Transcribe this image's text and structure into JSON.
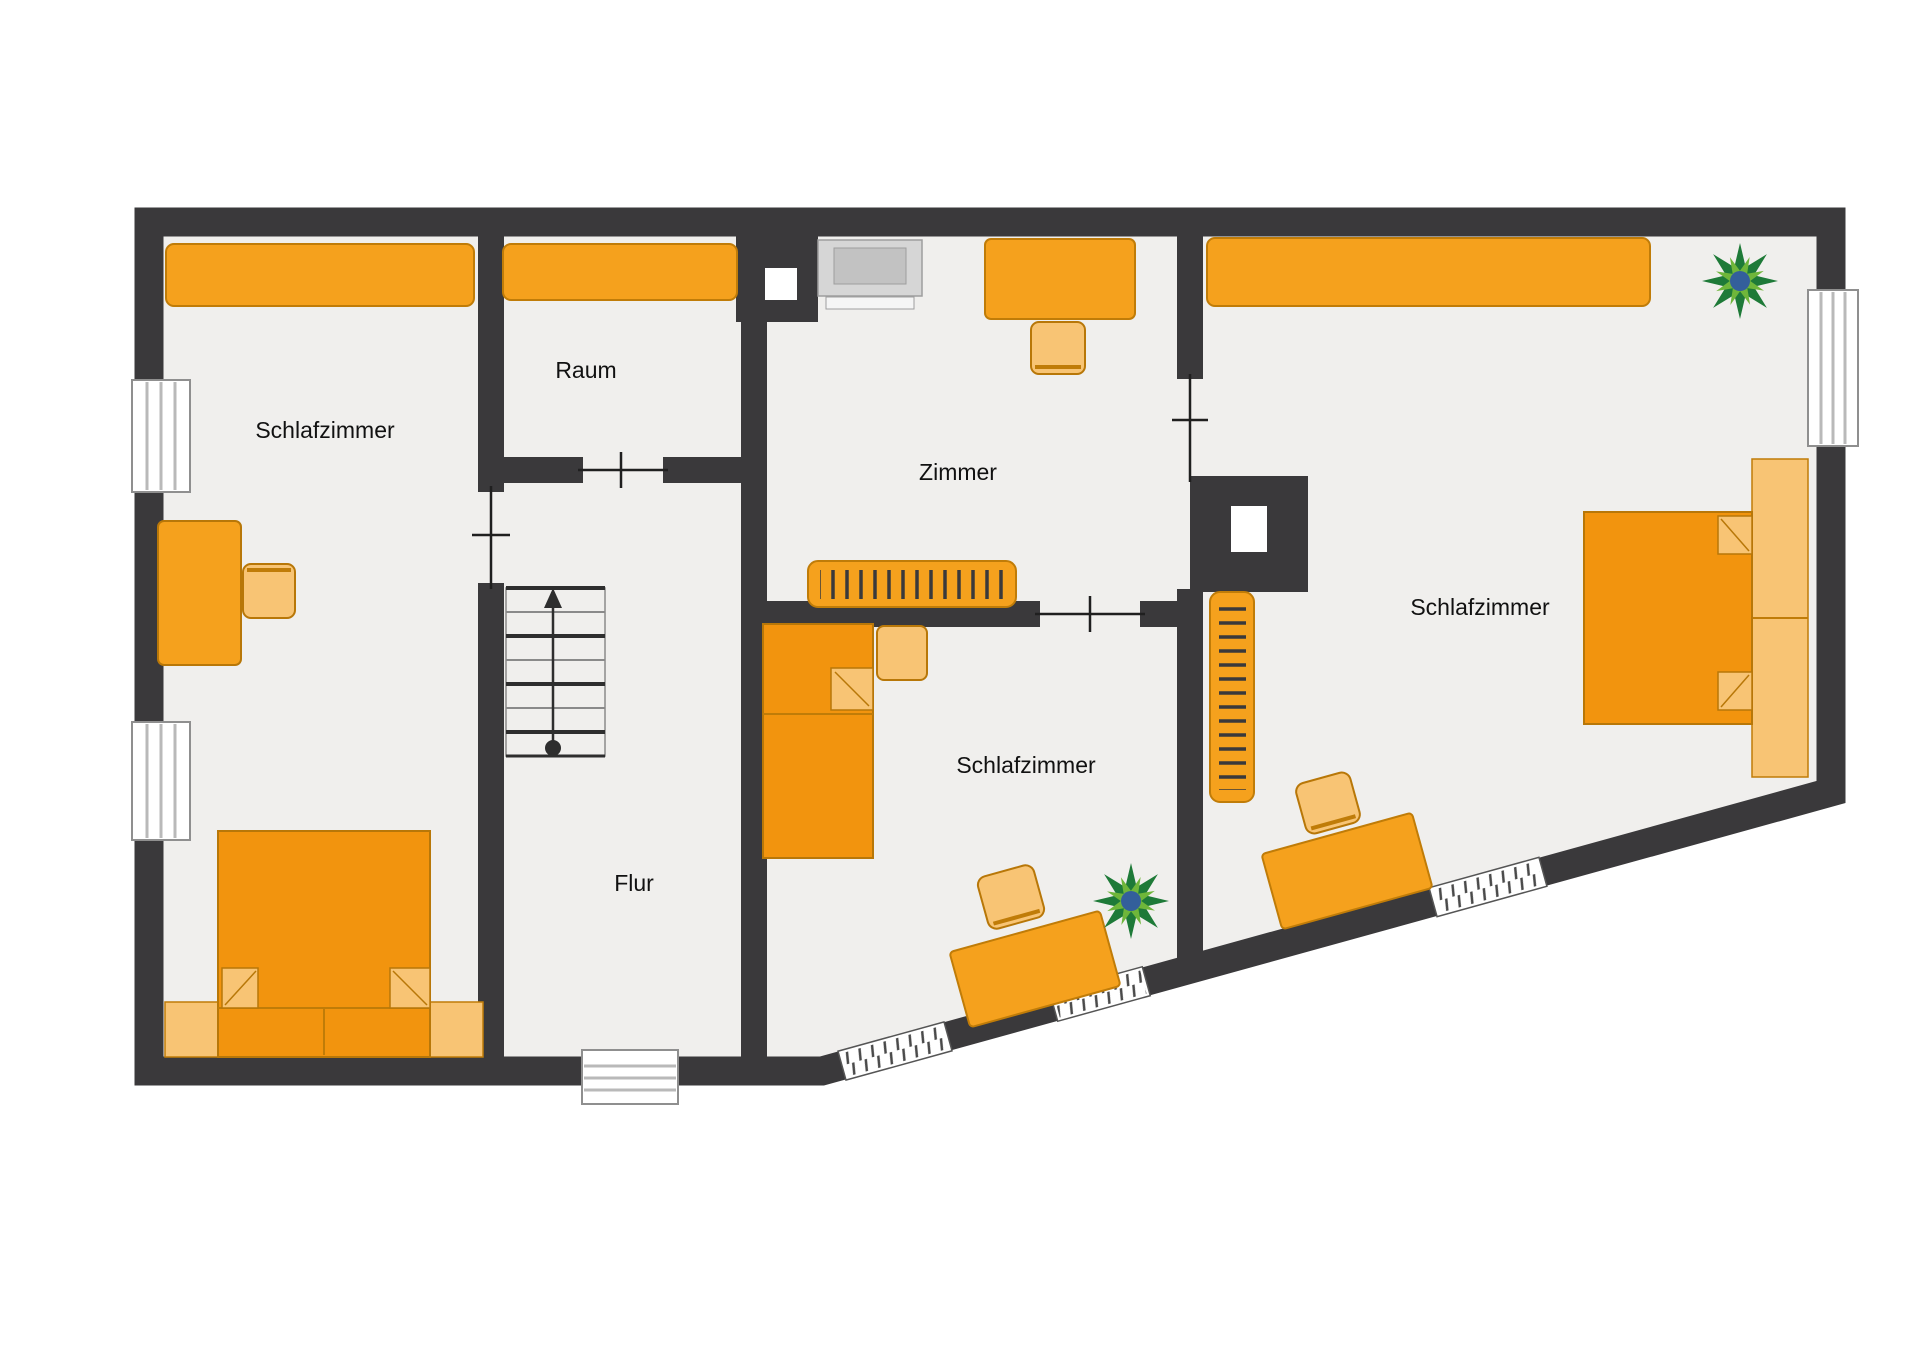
{
  "title": "Obergeschoss Grundriss (floor plan)",
  "rooms": [
    {
      "id": "schlafzimmer-left",
      "label": "Schlafzimmer"
    },
    {
      "id": "raum",
      "label": "Raum"
    },
    {
      "id": "zimmer",
      "label": "Zimmer"
    },
    {
      "id": "schlafzimmer-middle",
      "label": "Schlafzimmer"
    },
    {
      "id": "schlafzimmer-right",
      "label": "Schlafzimmer"
    },
    {
      "id": "flur",
      "label": "Flur"
    }
  ],
  "furniture": {
    "schlafzimmer_left": [
      "wardrobe",
      "desk",
      "chair",
      "double-bed with pillows and bench"
    ],
    "raum": [
      "wardrobe"
    ],
    "zimmer": [
      "tv-monitor",
      "desk",
      "chair",
      "hanger-wardrobe",
      "chimney with white flue"
    ],
    "schlafzimmer_middle": [
      "single-bed with pillow",
      "nightstand",
      "rotated desk",
      "rotated chair",
      "plant"
    ],
    "schlafzimmer_right": [
      "wardrobe",
      "hanger-wardrobe",
      "double-bed with pillows and headboard bench",
      "rotated desk",
      "rotated chair",
      "plant",
      "chimney with white flue"
    ],
    "flur": [
      "staircase with up-arrow"
    ]
  },
  "icons": [
    "plant-icon",
    "tv-icon",
    "stairs-arrow-icon",
    "window-icon",
    "door-marker-icon",
    "chimney-icon"
  ],
  "colors": {
    "wall": "#3a393b",
    "floor": "#f0efed",
    "outside": "#ffffff",
    "orange": "#f5a11d",
    "orange_dark": "#f2940e",
    "orange_light": "#f8c474",
    "orange_stroke": "#c07c08",
    "orange_stroke2": "#b87708",
    "plant_green_dark": "#1e7a38",
    "plant_green_light": "#6fb63a",
    "plant_blue": "#335f9b",
    "win_frame": "#8f8f8f",
    "win_line": "#b9b9b9",
    "label": "#111111",
    "tv_body": "#d6d6d6",
    "tv_inner": "#c2c2c2",
    "tv_screen": "#f5f5f5",
    "tv_stroke": "#9e9e9e",
    "door_line": "#1f1f1f",
    "stair_dark": "#2e2e2e",
    "stair_light": "#8a8a8a"
  }
}
